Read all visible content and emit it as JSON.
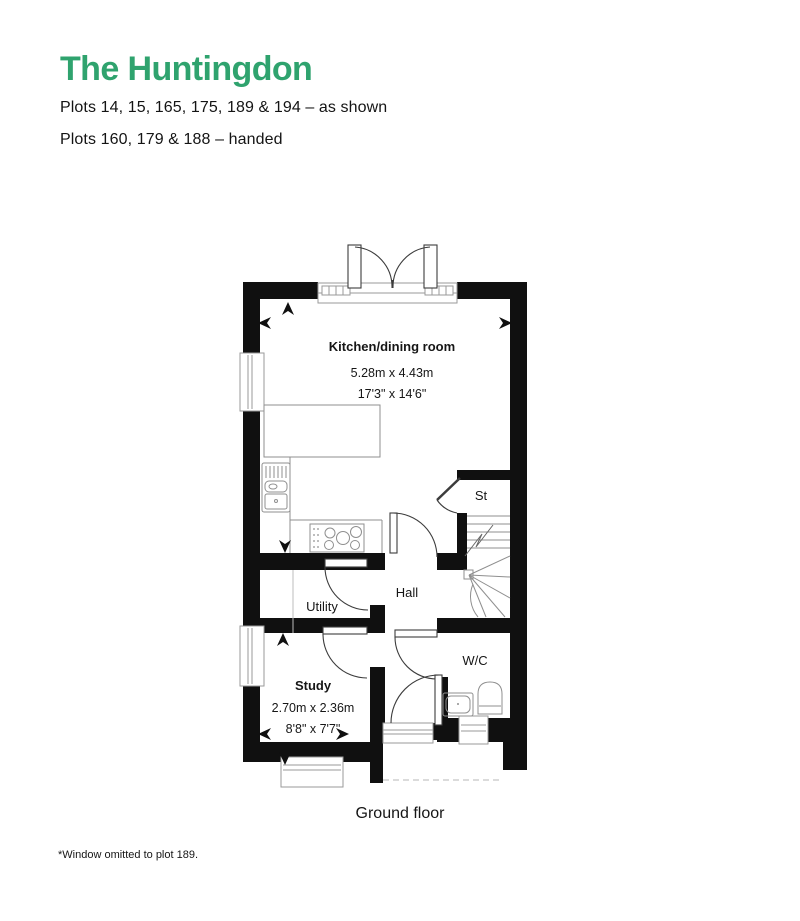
{
  "header": {
    "title": "The Huntingdon",
    "subtitle_line1": "Plots 14, 15, 165, 175, 189 & 194 – as shown",
    "subtitle_line2": "Plots 160, 179 & 188 – handed"
  },
  "floorplan": {
    "rooms": {
      "kitchen": {
        "name": "Kitchen/dining room",
        "dim_metric": "5.28m x 4.43m",
        "dim_imperial": "17'3\" x 14'6\""
      },
      "store": {
        "name": "St"
      },
      "hall": {
        "name": "Hall"
      },
      "utility": {
        "name": "Utility"
      },
      "wc": {
        "name": "W/C"
      },
      "study": {
        "name": "Study",
        "dim_metric": "2.70m x 2.36m",
        "dim_imperial": "8'8\" x 7'7\""
      }
    },
    "caption": "Ground floor"
  },
  "footnote": "*Window omitted to plot 189.",
  "colors": {
    "accent_green": "#2fa36e",
    "wall_black": "#101010",
    "fixture_grey": "#8f8f8f"
  }
}
